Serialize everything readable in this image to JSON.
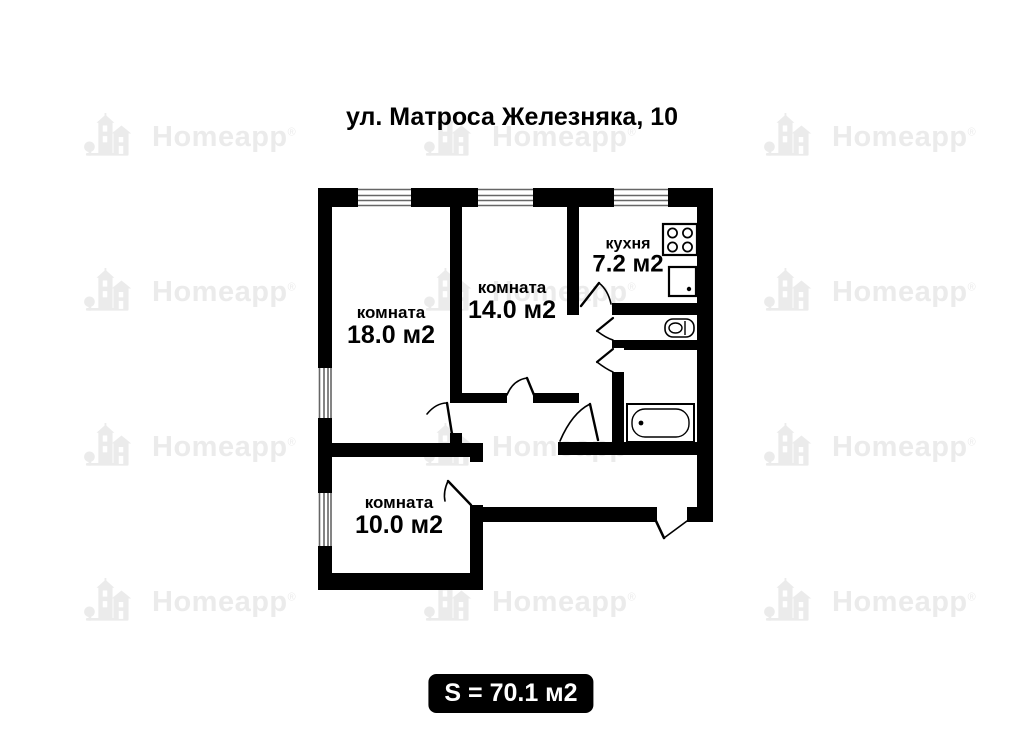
{
  "title": "ул. Матроса Железняка, 10",
  "watermark": {
    "brand": "Homeapp",
    "registered": "®"
  },
  "rooms": [
    {
      "name": "комната",
      "area": "18.0 м2"
    },
    {
      "name": "комната",
      "area": "14.0 м2"
    },
    {
      "name": "кухня",
      "area": "7.2 м2"
    },
    {
      "name": "комната",
      "area": "10.0 м2"
    }
  ],
  "total_area": {
    "text": "S = 70.1 м2"
  },
  "fixtures": [
    "stove-icon",
    "sink-icon",
    "toilet-icon",
    "bathtub-icon"
  ],
  "colors": {
    "wall": "#000000",
    "background": "#ffffff",
    "watermark": "#ebebeb",
    "badge-bg": "#000000",
    "badge-text": "#ffffff"
  }
}
